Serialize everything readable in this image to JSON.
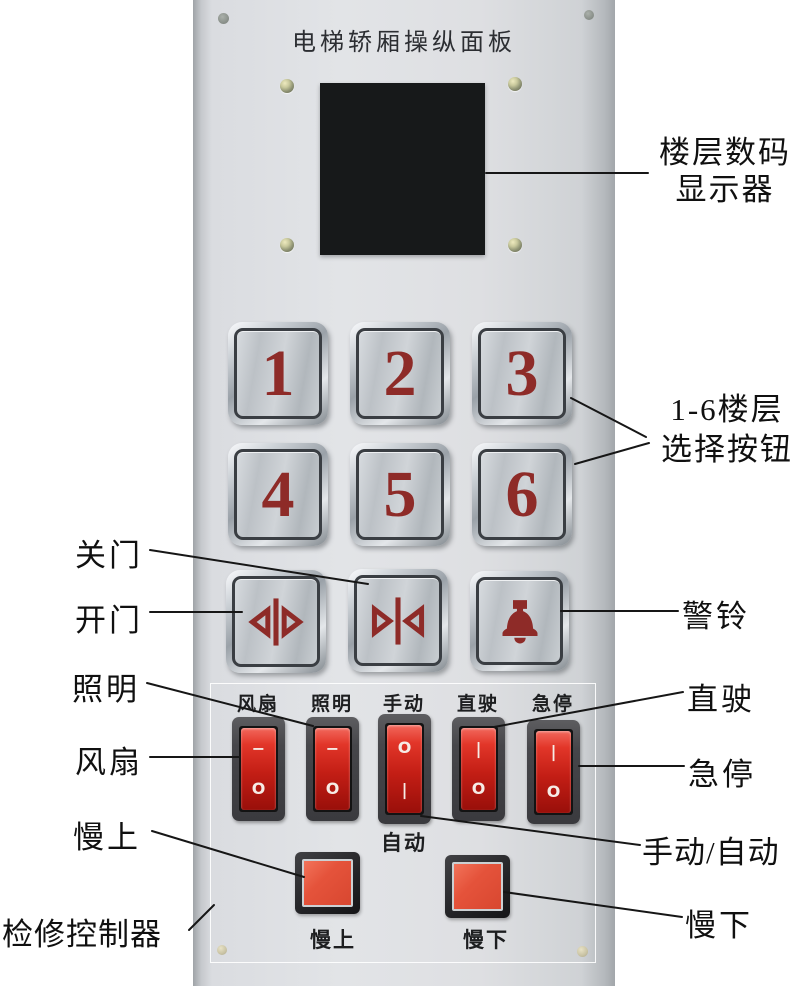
{
  "title": "电梯轿厢操纵面板",
  "floor_buttons": [
    "1",
    "2",
    "3",
    "4",
    "5",
    "6"
  ],
  "icons": {
    "open_door": "door-open-icon",
    "close_door": "door-close-icon",
    "alarm": "bell-icon"
  },
  "switch_panel": {
    "labels": [
      "风扇",
      "照明",
      "手动",
      "直驶",
      "急停"
    ],
    "auto_label": "自动",
    "switches": [
      {
        "top": "−",
        "bottom": "O"
      },
      {
        "top": "−",
        "bottom": "O"
      },
      {
        "top": "O",
        "bottom": "|"
      },
      {
        "top": "|",
        "bottom": "O"
      },
      {
        "top": "|",
        "bottom": "O"
      }
    ],
    "slow_up_label": "慢上",
    "slow_down_label": "慢下"
  },
  "callouts": {
    "display_line1": "楼层数码",
    "display_line2": "显示器",
    "floors_line1": "1-6楼层",
    "floors_line2": "选择按钮",
    "close_door": "关门",
    "open_door": "开门",
    "bell": "警铃",
    "lighting": "照明",
    "fan": "风扇",
    "slow_up": "慢上",
    "inspection": "检修控制器",
    "direct_drive": "直驶",
    "emergency_stop": "急停",
    "manual_auto": "手动/自动",
    "slow_down": "慢下"
  },
  "colors": {
    "digit_red": "#8e2b28",
    "rocker_red": "#c8211a",
    "pushbutton_red": "#e2513a",
    "panel_gray": "#dfe1e4"
  }
}
